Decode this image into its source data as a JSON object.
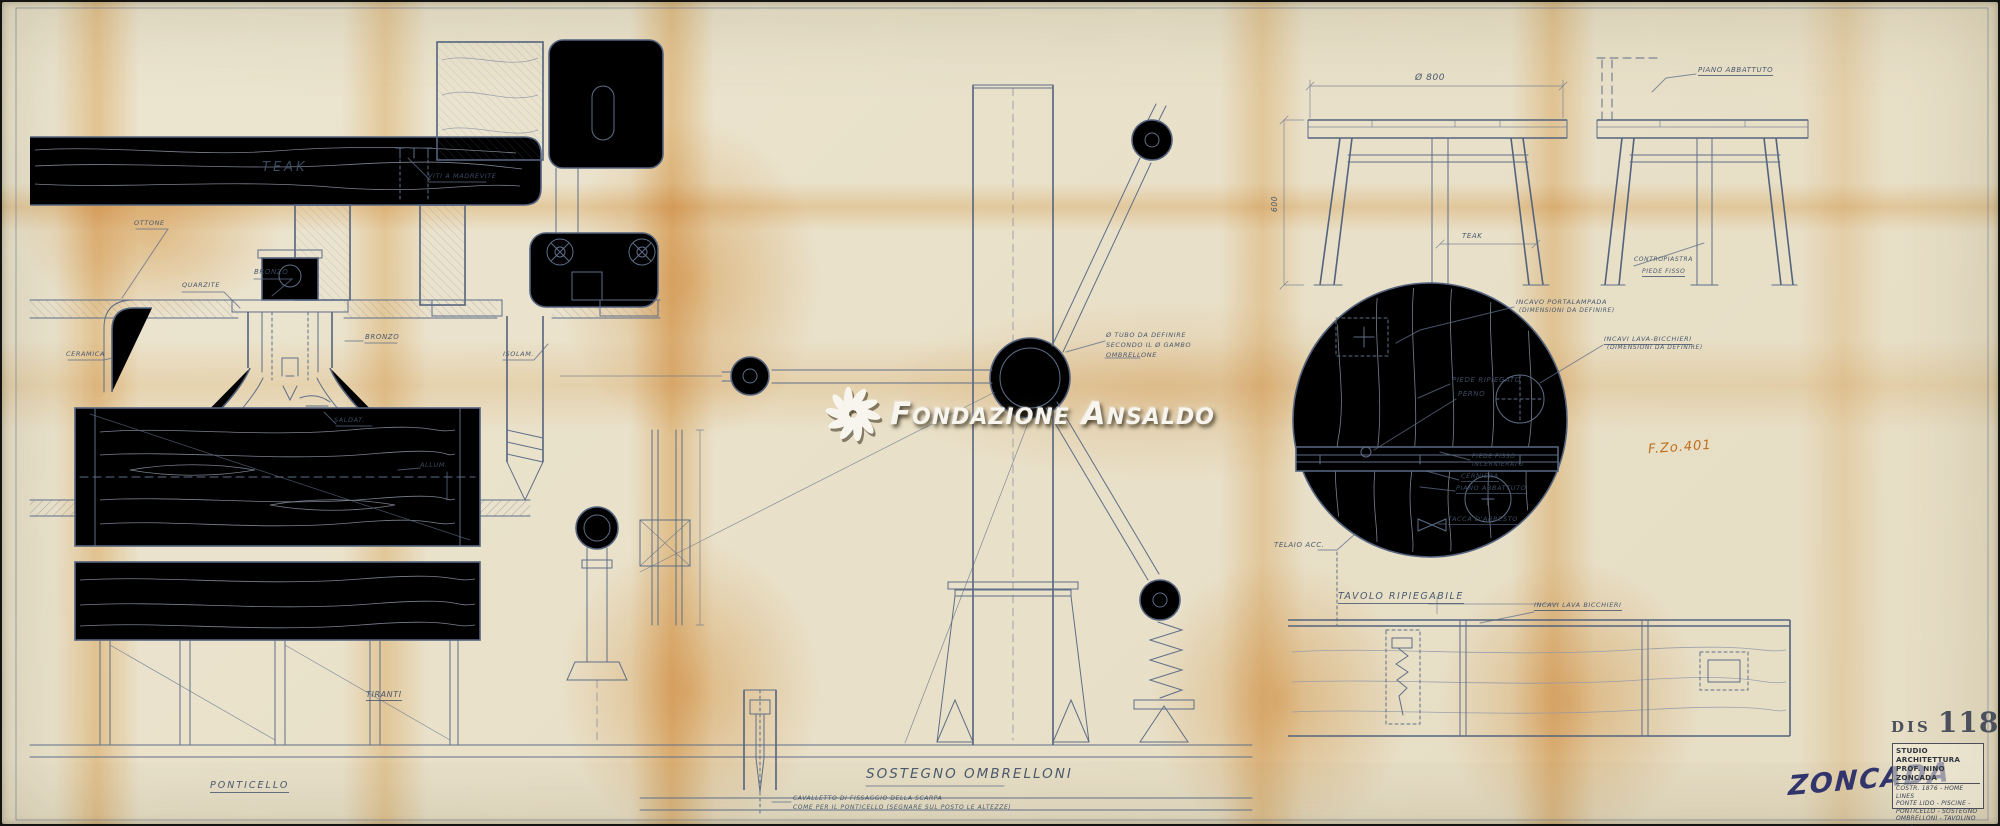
{
  "watermark": {
    "brand": "Fondazione Ansaldo",
    "logo": "pinwheel-icon"
  },
  "stamps": {
    "drawing_ref": "F.Zo.401",
    "signature": "ZONCADA"
  },
  "title_block": {
    "dis_label": "DIS",
    "dis_number": "118",
    "studio_line1": "STUDIO ARCHITETTURA",
    "studio_line2": "PROF. NINO ZONCADA",
    "subject_line1": "COSTR. 1876 - HOME LINES",
    "subject_line2": "PONTE LIDO - PISCINE -",
    "subject_line3": "PONTICELLO - SOSTEGNO",
    "subject_line4": "OMBRELLONI - TAVOLINO",
    "data_label": "DATA",
    "data_value": "7-11-64",
    "scala_label": "SCALA",
    "scala_value": "1:1 1:5",
    "dis_no_label": "DIS. Nº",
    "dis_no_value": "118"
  },
  "labels": {
    "teak_plank": "TEAK",
    "viti": "VITI A MADREVITE",
    "bronzo_top": "BRONZO",
    "bronzo_socket": "BRONZO",
    "quarzite": "QUARZITE",
    "ottone": "OTTONE",
    "ceramica": "CERAMICA",
    "saldat": "SALDAT.",
    "allum": "ALLUM.",
    "isolam": "ISOLAM.",
    "tiranti": "TIRANTI",
    "ponticello": "PONTICELLO",
    "tubo_line1": "Ø TUBO DA DEFINIRE",
    "tubo_line2": "SECONDO IL Ø GAMBO",
    "tubo_line3": "OMBRELLONE",
    "sostegno_ombrelloni": "SOSTEGNO OMBRELLONI",
    "cavalletto_line1": "CAVALLETTO DI FISSAGGIO DELLA SCARPA",
    "cavalletto_line2": "COME PER IL PONTICELLO (SEGNARE SUL POSTO LE ALTEZZE)",
    "dia_800": "Ø 800",
    "dim_600": "600",
    "teak_table": "TEAK",
    "piano_abbattuto_top": "PIANO ABBATTUTO",
    "contropiastra": "CONTROPIASTRA",
    "piede_fisso_top": "PIEDE FISSO",
    "incavo_portalampada_l1": "INCAVO PORTALAMPADA",
    "incavo_portalampada_l2": "(DIMENSIONI DA DEFINIRE)",
    "incavi_lavabicchieri_l1": "INCAVI LAVA-BICCHIERI",
    "incavi_lavabicchieri_l2": "(DIMENSIONI DA DEFINIRE)",
    "piede_ripiegato": "PIEDE RIPIEGATO",
    "perno": "PERNO",
    "piede_fisso_l1": "PIEDE FISSO",
    "piede_fisso_l2": "INCERNIERATO",
    "cerniera": "CERNIERA",
    "piano_abbattuto_circle": "PIANO ABBATTUTO",
    "tacca_arresto": "TACCA D'ARRESTO",
    "telaio_acc": "TELAIO ACC.",
    "tavolo_ripiegabile": "TAVOLO RIPIEGABILE",
    "incavi_lava_bicchieri_bottom": "INCAVI LAVA BICCHIERI"
  },
  "colors": {
    "paper": "#e9e1ca",
    "pencil": "#5e6e88",
    "fold_tint": "#e5992b",
    "stamp_orange": "#c06e1d",
    "signature_ink": "#32356b",
    "watermark": "#f7f5ee"
  }
}
